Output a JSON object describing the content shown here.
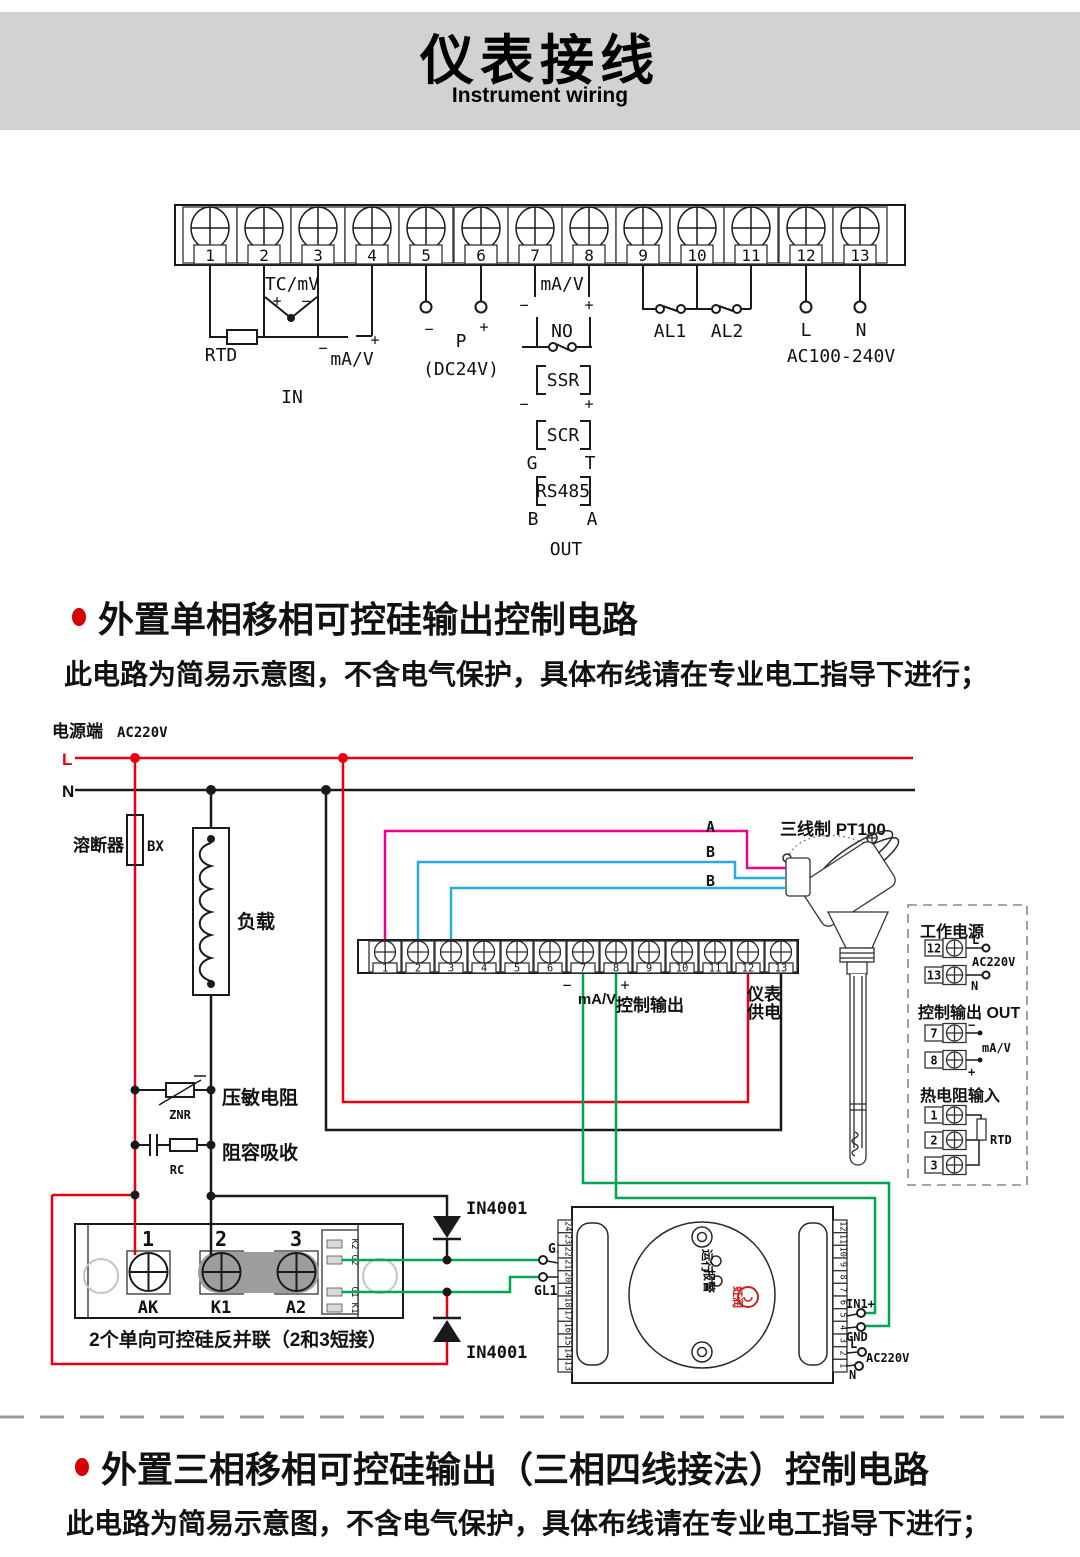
{
  "header": {
    "title": "仪表接线",
    "subtitle": "Instrument wiring"
  },
  "top_strip": {
    "terminals": [
      "1",
      "2",
      "3",
      "4",
      "5",
      "6",
      "7",
      "8",
      "9",
      "10",
      "11",
      "12",
      "13"
    ]
  },
  "top_wiring": {
    "tc": "TC/mV",
    "rtd": "RTD",
    "ma_v": "mA/V",
    "in": "IN",
    "p": "P",
    "dc24v": "(DC24V)",
    "no": "NO",
    "ssr": "SSR",
    "scr": "SCR",
    "g": "G",
    "t": "T",
    "rs485": "RS485",
    "b": "B",
    "a": "A",
    "out": "OUT",
    "al1": "AL1",
    "al2": "AL2",
    "l": "L",
    "n": "N",
    "ac": "AC100-240V",
    "plus": "+",
    "minus": "−"
  },
  "section1": {
    "title": "外置单相移相可控硅输出控制电路",
    "note": "此电路为简易示意图，不含电气保护，具体布线请在专业电工指导下进行；"
  },
  "circuit": {
    "power": "电源端",
    "volt": "AC220V",
    "l": "L",
    "n": "N",
    "fuse": "溶断器",
    "bx": "BX",
    "load": "负载",
    "znr_cn": "压敏电阻",
    "znr": "ZNR",
    "rc_cn": "阻容吸收",
    "rc": "RC",
    "strip": {
      "terminals": [
        "1",
        "2",
        "3",
        "4",
        "5",
        "6",
        "7",
        "8",
        "9",
        "10",
        "11",
        "12",
        "13"
      ]
    },
    "minus": "−",
    "plus": "+",
    "ma_v": "mA/V",
    "ctrl": "控制输出",
    "supply1": "仪表",
    "supply2": "供电",
    "a": "A",
    "b": "B",
    "pt100": "三线制 PT100",
    "in4001": "IN4001",
    "g1": "G1",
    "gl1": "GL1",
    "module": {
      "n1": "1",
      "n2": "2",
      "n3": "3",
      "ak": "AK",
      "k1": "K1",
      "a2": "A2",
      "s1": "K2",
      "s2": "G2",
      "s3": "G1",
      "s4": "K1",
      "caption": "2个单向可控硅反并联（2和3短接）"
    },
    "meter": {
      "left": [
        "24",
        "23",
        "22",
        "21",
        "20",
        "19",
        "18",
        "17",
        "16",
        "15",
        "14",
        "13"
      ],
      "right": [
        "12",
        "11",
        "10",
        "9",
        "8",
        "7",
        "6",
        "5",
        "4",
        "3",
        "2",
        "1"
      ],
      "run": "运行",
      "alarm": "报警",
      "brand": "虹润",
      "in1": "IN1+",
      "gnd": "GND",
      "l": "L",
      "ac": "AC220V",
      "n": "N"
    },
    "panel": {
      "power_title": "工作电源",
      "t12": "12",
      "t13": "13",
      "l": "L",
      "ac": "AC220V",
      "n": "N",
      "ctrl_title": "控制输出 OUT",
      "t7": "7",
      "t8": "8",
      "ma_v": "mA/V",
      "rtd_title": "热电阻输入",
      "t1": "1",
      "t2": "2",
      "t3": "3",
      "rtd": "RTD"
    }
  },
  "section2": {
    "title": "外置三相移相可控硅输出（三相四线接法）控制电路",
    "note": "此电路为简易示意图，不含电气保护，具体布线请在专业电工指导下进行；"
  }
}
